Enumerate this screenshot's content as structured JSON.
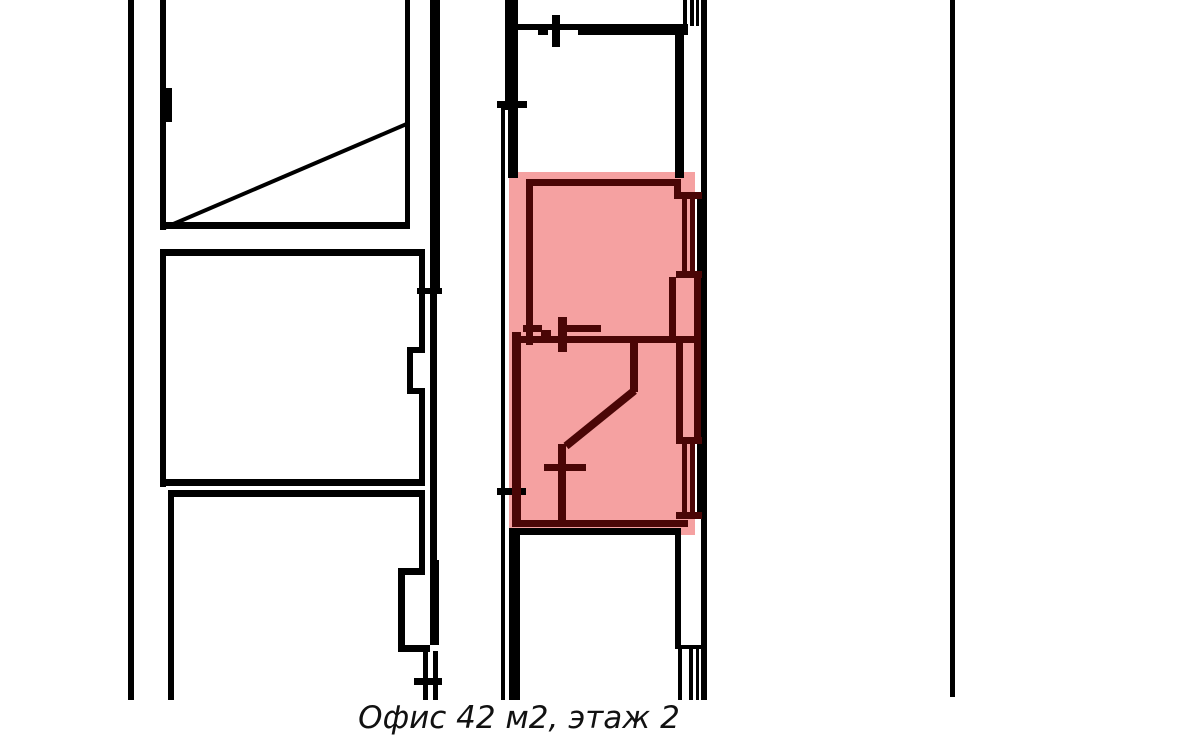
{
  "page": {
    "caption": "Офис 42 м2, этаж 2"
  },
  "highlight_label": "highlighted-office-area",
  "colors": {
    "wall": "#000000",
    "office_wall": "#4a0606",
    "highlight": "#f5a1a1",
    "background": "#ffffff",
    "caption_text": "#111111"
  }
}
